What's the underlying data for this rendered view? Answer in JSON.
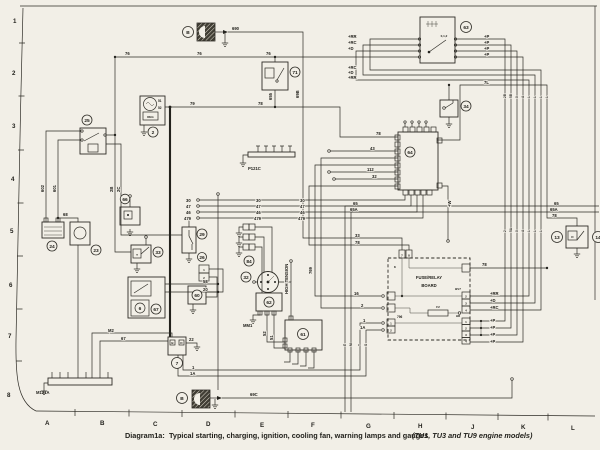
{
  "frame": {
    "rows": [
      "1",
      "2",
      "3",
      "4",
      "5",
      "6",
      "7",
      "8"
    ],
    "cols": [
      "A",
      "B",
      "C",
      "D",
      "E",
      "F",
      "G",
      "H",
      "J",
      "K",
      "L"
    ]
  },
  "caption": {
    "label": "Diagram1a:",
    "text": "Typical starting, charging, ignition, cooling fan, warning lamps and gauges",
    "models": "(TU1, TU3 and TU9 engine models)"
  },
  "callouts": {
    "b": "B",
    "n2": "2",
    "n6": "6",
    "n7": "7",
    "n13": "13",
    "n14": "14",
    "n23": "23",
    "n24": "24",
    "n25": "25",
    "n26": "26",
    "n29": "29",
    "n32": "32",
    "n33": "33",
    "n34": "34",
    "n60": "60",
    "n61": "61",
    "n62": "62",
    "n63": "63",
    "n64": "64",
    "n66": "66",
    "n67": "67",
    "n71": "71",
    "n84": "84"
  },
  "labels": {
    "m121a": "M121A",
    "p121c": "P121C",
    "mm1": "MM1",
    "high_tension": "HIGH TENSION",
    "board_line1": "FUSE/RELAY",
    "board_line2": "BOARD",
    "reg": "REG",
    "f2": "F2",
    "k": "K",
    "p796": "796",
    "ign_positions": "0,1,2",
    "bv7": "BV7",
    "hr": "HR"
  },
  "wires": {
    "w690": "690",
    "w69b": "69B",
    "w69c": "69C",
    "w76": "76",
    "w79": "79",
    "w78": "78",
    "w655": "655",
    "w602": "602",
    "w601": "601",
    "w68": "68",
    "w2b": "2B",
    "w2c": "2C",
    "w51": "51",
    "w52": "52",
    "w30": "30",
    "w47": "47",
    "w46": "46",
    "w479": "479",
    "w43": "43",
    "w112": "112",
    "w32": "32",
    "w33": "33",
    "w65": "65",
    "w65a": "65A",
    "w7l": "7L",
    "wp": "+P",
    "wrr": "+RR",
    "wrc": "+RC",
    "wd": "+D",
    "ww": "+W",
    "w16": "16",
    "w2": "2",
    "w1": "1",
    "w1a": "1A",
    "w22": "22",
    "wm2": "M2",
    "w67": "67",
    "w58": "58",
    "w20": "20",
    "w769": "769"
  },
  "bundle": {
    "top": [
      "2B",
      "5B",
      "0",
      "A",
      "L",
      "L",
      "L",
      "L"
    ],
    "mid": [
      "2",
      "5A",
      "0",
      "A",
      "L",
      "L",
      "L",
      "L"
    ],
    "bot": [
      "E",
      "M",
      "T",
      "S"
    ]
  },
  "pins": {
    "board_top": [
      "7",
      "8"
    ],
    "bv7": [
      "2",
      "3",
      "4"
    ],
    "hr": [
      "1",
      "2",
      "3",
      "4"
    ],
    "left796": [
      "1",
      "2"
    ],
    "p26": [
      "1",
      "2"
    ],
    "d13": "D",
    "t33": "T",
    "b7": "B",
    "d7": "D"
  }
}
